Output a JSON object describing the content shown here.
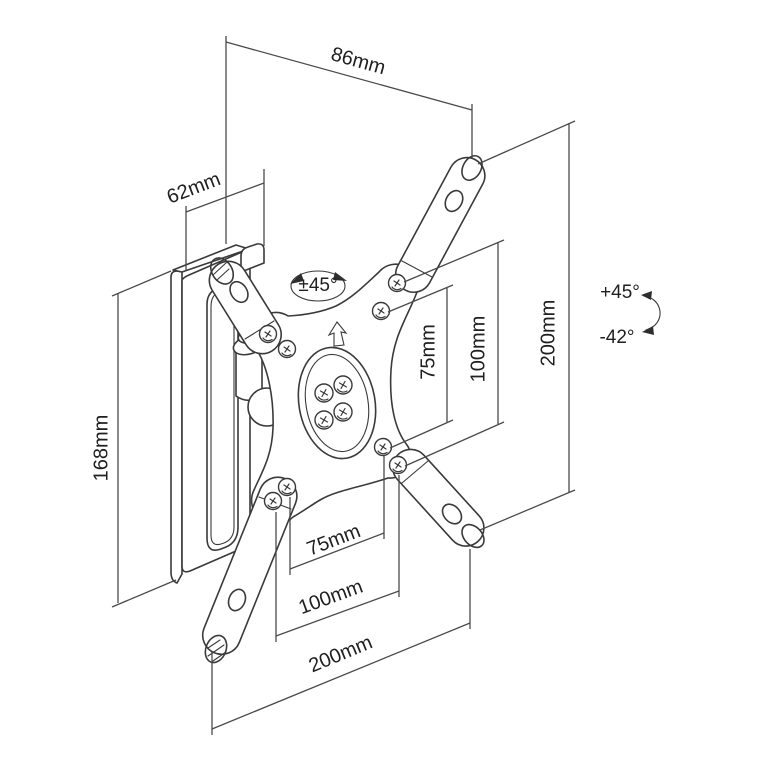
{
  "diagram": {
    "type": "technical-drawing",
    "subject": "Tilt and swivel TV wall mount bracket, dimensioned isometric view",
    "colors": {
      "background": "#ffffff",
      "line": "#3a3a3a",
      "text": "#1f1f1f"
    },
    "dimensions": {
      "depth_top": "86mm",
      "wall_plate_width": "62mm",
      "wall_plate_height": "168mm",
      "plate_height_right": "200mm",
      "vesa_vertical_75": "75mm",
      "vesa_vertical_100": "100mm",
      "vesa_horizontal_75": "75mm",
      "vesa_horizontal_100": "100mm",
      "plate_width_bottom": "200mm"
    },
    "angles": {
      "swivel": "±45°",
      "tilt_up": "+45°",
      "tilt_down": "-42°"
    },
    "icons": {
      "orientation_arrow": "up-arrow",
      "swivel_arrow": "curved-double-arrow",
      "tilt_arrow": "curved-double-arrow"
    }
  }
}
